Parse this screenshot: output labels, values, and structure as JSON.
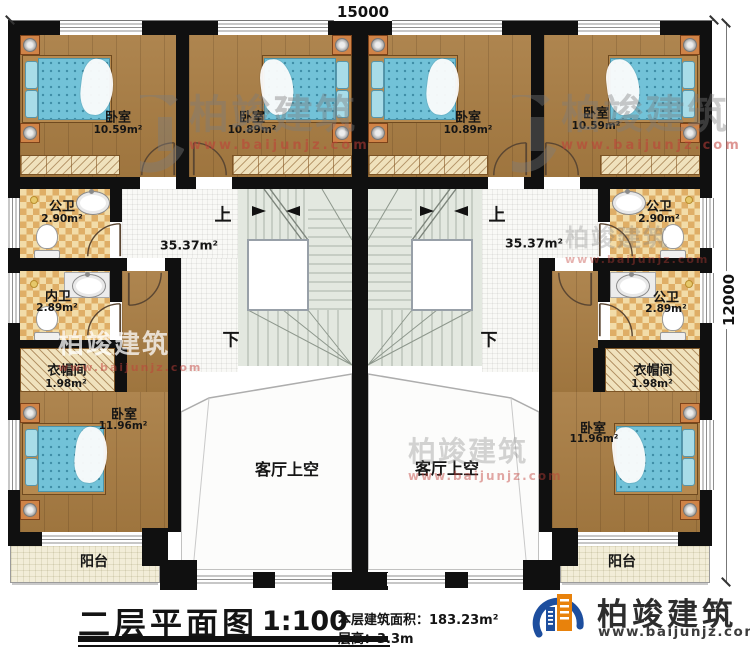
{
  "dimensions": {
    "top": "15000",
    "right": "12000"
  },
  "title_block": {
    "title": "二层平面图",
    "scale": "1:100",
    "area_label": "本层建筑面积：",
    "area_value": "183.23m²",
    "floor_height_label": "层高：",
    "floor_height_value": "3.3m"
  },
  "brand": {
    "name": "柏竣建筑",
    "url": "www.baijunjz.com"
  },
  "watermark": {
    "name": "柏竣建筑",
    "url": "www.baijunjz.com"
  },
  "colors": {
    "wall": "#101010",
    "wood": "#a87c42",
    "tile_dark": "#dfae66",
    "stair": "#e3e8e0",
    "brand_blue": "#1d4e9e",
    "brand_orange": "#e8820c"
  },
  "left_unit": {
    "bedroom_top_left": {
      "label": "卧室",
      "area": "10.59m²"
    },
    "bedroom_top_mid": {
      "label": "卧室",
      "area": "10.89m²"
    },
    "bath_public": {
      "label": "公卫",
      "area": "2.90m²"
    },
    "bath_inner": {
      "label": "内卫",
      "area": "2.89m²"
    },
    "cloakroom": {
      "label": "衣帽间",
      "area": "1.98m²"
    },
    "bedroom_bottom": {
      "label": "卧室",
      "area": "11.96m²"
    },
    "balcony": {
      "label": "阳台"
    },
    "hall": {
      "area": "35.37m²"
    },
    "living_void": {
      "label": "客厅上空"
    },
    "stairs": {
      "up": "上",
      "down": "下"
    }
  },
  "right_unit": {
    "bedroom_top_mid": {
      "label": "卧室",
      "area": "10.89m²"
    },
    "bedroom_top_right": {
      "label": "卧室",
      "area": "10.59m²"
    },
    "bath_public_top": {
      "label": "公卫",
      "area": "2.90m²"
    },
    "bath_public_mid": {
      "label": "公卫",
      "area": "2.89m²"
    },
    "cloakroom": {
      "label": "衣帽间",
      "area": "1.98m²"
    },
    "bedroom_bottom": {
      "label": "卧室",
      "area": "11.96m²"
    },
    "balcony": {
      "label": "阳台"
    },
    "hall": {
      "area": "35.37m²"
    },
    "living_void": {
      "label": "客厅上空"
    },
    "stairs": {
      "up": "上",
      "down": "下"
    }
  }
}
